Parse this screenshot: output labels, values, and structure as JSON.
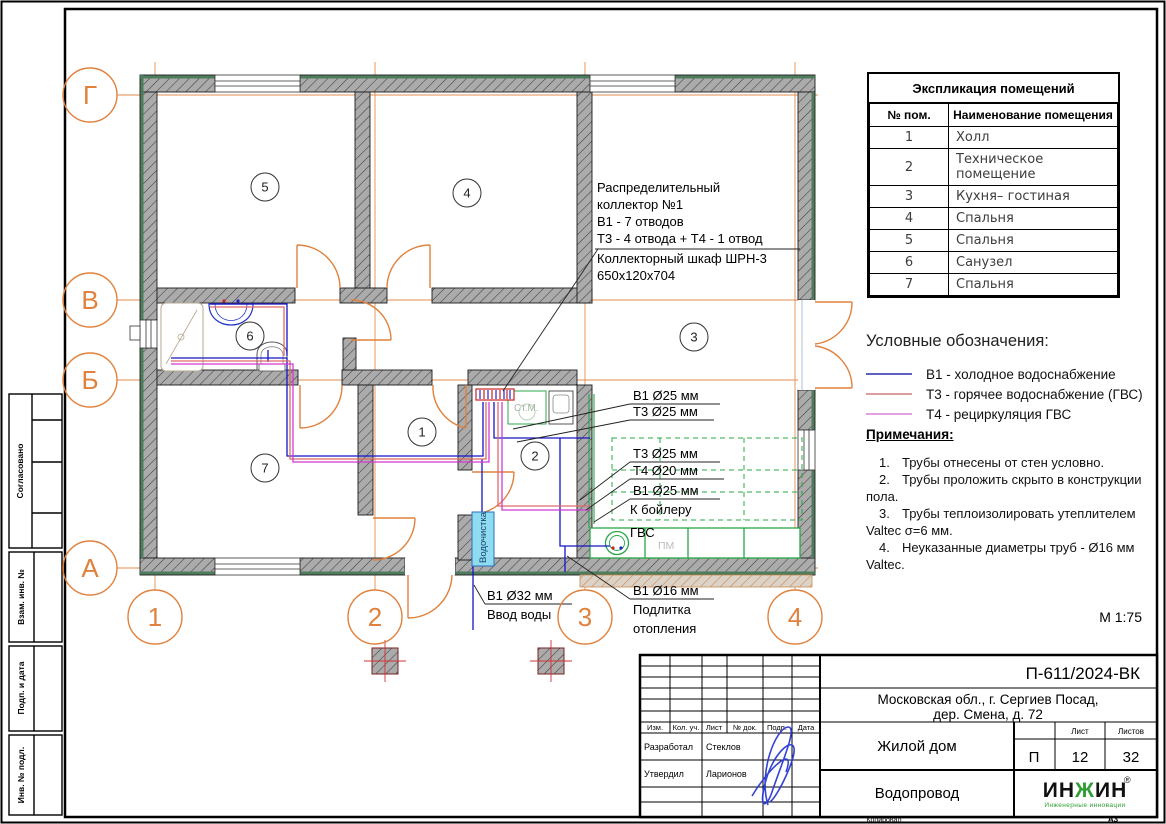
{
  "margin_stamps": {
    "agreed": "Согласовано",
    "replace_inv": "Взам. инв. №",
    "sign_date": "Подп. и дата",
    "inv_no": "Инв. № подл."
  },
  "axes": {
    "rows": [
      "Г",
      "В",
      "Б",
      "А"
    ],
    "cols": [
      "1",
      "2",
      "3",
      "4"
    ]
  },
  "room_numbers": [
    "1",
    "2",
    "3",
    "4",
    "5",
    "6",
    "7"
  ],
  "plan": {
    "collector_note": [
      "Распределительный",
      "коллектор №1",
      "В1 - 7 отводов",
      "Т3 - 4 отвода + Т4 - 1 отвод",
      "Коллекторный шкаф ШРН-3",
      "650х120х704"
    ],
    "pipe_labels_top": [
      "В1 Ø25 мм",
      "Т3 Ø25 мм"
    ],
    "pipe_labels_boiler": [
      "Т3 Ø25 мм",
      "Т4 Ø20 мм",
      "В1 Ø25 мм",
      "К бойлеру",
      "ГВС"
    ],
    "makeup_label": [
      "В1 Ø16 мм",
      "Подлитка",
      "отопления"
    ],
    "inlet_label": [
      "В1 Ø32 мм",
      "Ввод воды"
    ],
    "water_treatment": "Водочистка",
    "washing_machine": "Ст.М.",
    "dishwasher": "ПМ",
    "scale": "М 1:75"
  },
  "schedule": {
    "title": "Экспликация помещений",
    "col1": "№ пом.",
    "col2": "Наименование помещения",
    "rows": [
      [
        "1",
        "Холл"
      ],
      [
        "2",
        "Техническое помещение"
      ],
      [
        "3",
        "Кухня– гостиная"
      ],
      [
        "4",
        "Спальня"
      ],
      [
        "5",
        "Спальня"
      ],
      [
        "6",
        "Санузел"
      ],
      [
        "7",
        "Спальня"
      ]
    ]
  },
  "legend": {
    "title": "Условные обозначения:",
    "items": [
      {
        "label": "В1 - холодное водоснабжение",
        "color": "#2b2bb0"
      },
      {
        "label": "Т3 - горячее водоснабжение (ГВС)",
        "color": "#d07f7f"
      },
      {
        "label": "Т4 - рециркуляция ГВС",
        "color": "#d784d7"
      }
    ]
  },
  "notes": {
    "title": "Примечания:",
    "items": [
      {
        "n": "1.",
        "t": "Трубы отнесены от стен условно."
      },
      {
        "n": "2.",
        "t": "Трубы проложить скрыто в конструкции пола."
      },
      {
        "n": "3.",
        "t": "Трубы теплоизолировать утеплителем Valtec σ=6 мм."
      },
      {
        "n": "4.",
        "t": "Неуказанные диаметры труб - Ø16 мм Valtec."
      }
    ]
  },
  "titleblock": {
    "doc_number": "П-611/2024-ВК",
    "address1": "Московская обл., г. Сергиев Посад,",
    "address2": "дер. Смена, д. 72",
    "object": "Жилой дом",
    "sheet_title": "Водопровод",
    "col_izm": "Изм.",
    "col_kol": "Кол. уч.",
    "col_list": "Лист",
    "col_doc": "№ док.",
    "col_podp": "Подп.",
    "col_data": "Дата",
    "developed_label": "Разработал",
    "developed_name": "Стеклов",
    "approved_label": "Утвердил",
    "approved_name": "Ларионов",
    "stage_label": "Стадия",
    "sheet_label": "Лист",
    "sheets_label": "Листов",
    "stage": "П",
    "sheet": "12",
    "sheets": "32",
    "logo_p1": "ИН",
    "logo_zh": "Ж",
    "logo_p2": "ИН",
    "logo_reg": "®",
    "logo_sub": "Инженерные инновации",
    "copied": "Копировал",
    "format": "А3"
  }
}
